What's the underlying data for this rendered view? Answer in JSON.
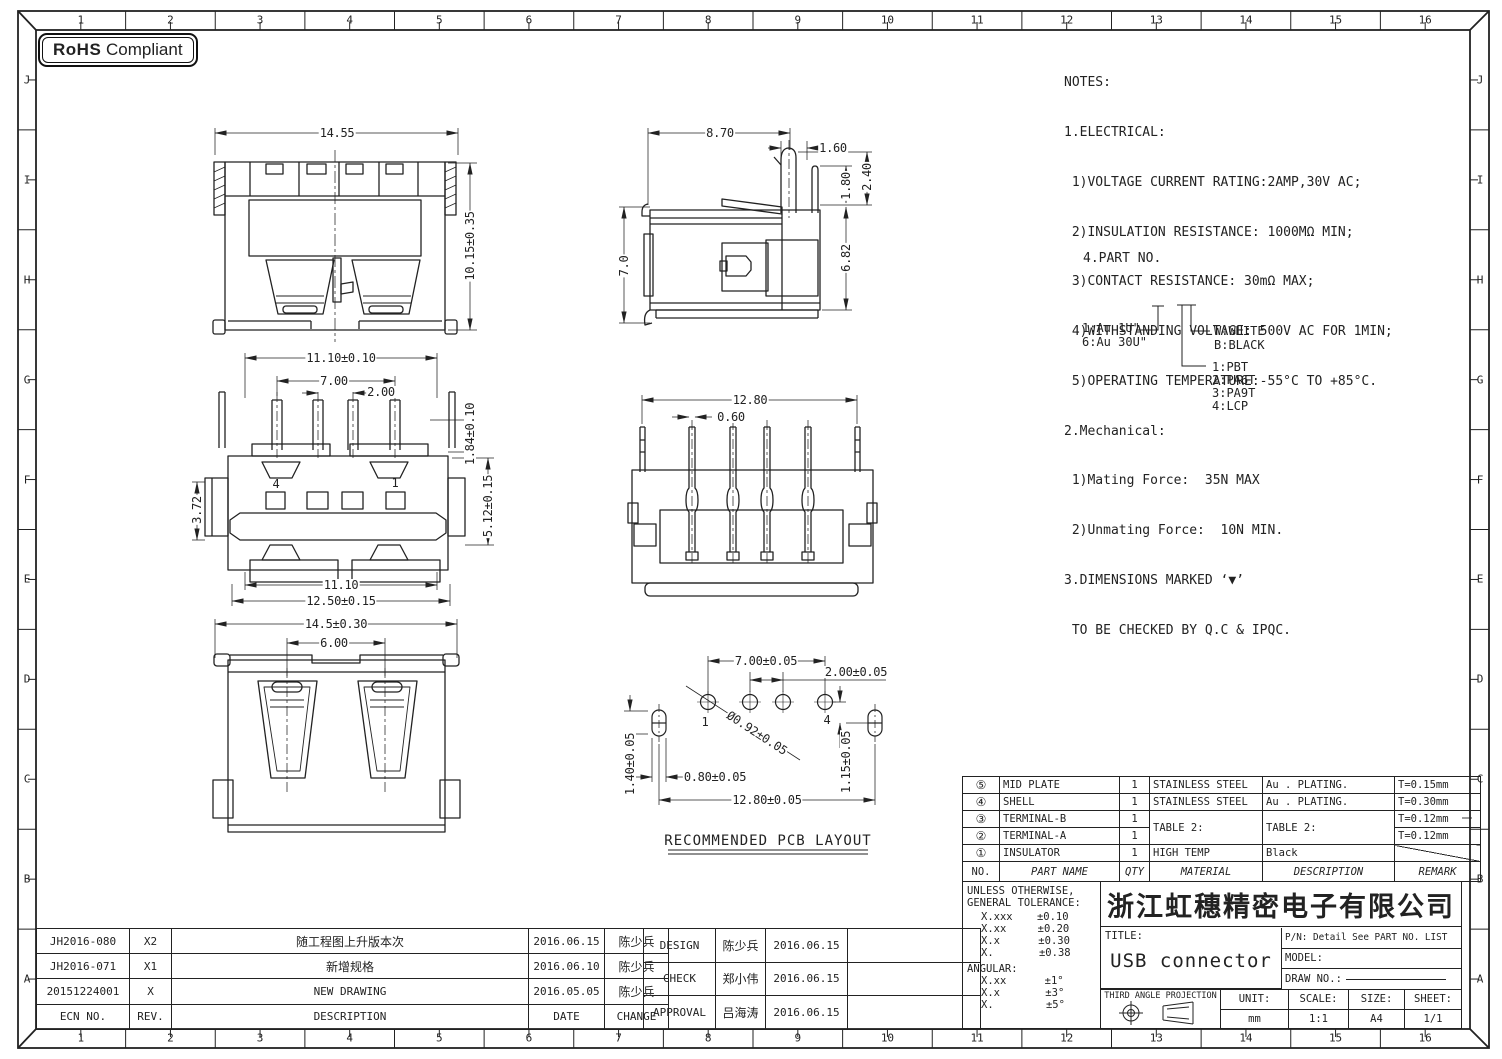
{
  "frame": {
    "numbers": [
      "1",
      "2",
      "3",
      "4",
      "5",
      "6",
      "7",
      "8",
      "9",
      "10",
      "11",
      "12",
      "13",
      "14",
      "15",
      "16"
    ],
    "letters": [
      "J",
      "I",
      "H",
      "G",
      "F",
      "E",
      "D",
      "C",
      "B",
      "A"
    ]
  },
  "rohs": {
    "strong": "RoHS",
    "text": "Compliant"
  },
  "notes": {
    "lines": [
      "NOTES:",
      "1.ELECTRICAL:",
      " 1)VOLTAGE CURRENT RATING:2AMP,30V AC;",
      " 2)INSULATION RESISTANCE: 1000MΩ MIN;",
      " 3)CONTACT RESISTANCE: 30mΩ MAX;",
      " 4)WITHSTANDING VOLTAGE: 500V AC FOR 1MIN;",
      " 5)OPERATING TEMPERATURE:-55°C TO +85°C.",
      "2.Mechanical:",
      " 1)Mating Force:  35N MAX",
      " 2)Unmating Force:  10N MIN.",
      "3.DIMENSIONS MARKED ‘▼’",
      " TO BE CHECKED BY Q.C & IPQC."
    ],
    "part_no_label": "4.PART NO."
  },
  "tree": {
    "plate1": "1:Au 1U\"",
    "plate2": "6:Au 30U\"",
    "c1": "W:WHITE",
    "c2": "B:BLACK",
    "m1": "1:PBT",
    "m2": "2:PA6T",
    "m3": "3:PA9T",
    "m4": "4:LCP"
  },
  "dims": {
    "v1_w": "14.55",
    "v1_h": "10.15±0.35",
    "v2_w": "8.70",
    "v2_a": "1.60",
    "v2_b": "1.80",
    "v2_c": "2.40",
    "v2_h": "7.0",
    "v2_d": "6.82",
    "v3_top": "11.10±0.10",
    "v3_a": "7.00",
    "v3_b": "2.00",
    "v3_c": "1.84±0.10",
    "v3_d": "3.72",
    "v3_e": "5.12±0.15",
    "v3_p4": "4",
    "v3_p1": "1",
    "v3_f": "11.10",
    "v3_g": "12.50±0.15",
    "v4_w": "12.80",
    "v4_a": "0.60",
    "v5_w": "14.5±0.30",
    "v5_a": "6.00",
    "p_a": "7.00±0.05",
    "p_b": "2.00±0.05",
    "p_1": "1",
    "p_4": "4",
    "p_dia": "Ø0.92±0.05",
    "p_c": "1.40±0.05",
    "p_d": "0.80±0.05",
    "p_e": "1.15±0.05",
    "p_f": "12.80±0.05"
  },
  "pcb_caption": "RECOMMENDED PCB LAYOUT",
  "bom": {
    "headers": [
      "NO.",
      "PART NAME",
      "QTY",
      "MATERIAL",
      "DESCRIPTION",
      "REMARK"
    ],
    "rows": [
      [
        "⑤",
        "MID PLATE",
        "1",
        "STAINLESS STEEL",
        "Au . PLATING.",
        "T=0.15mm"
      ],
      [
        "④",
        "SHELL",
        "1",
        "STAINLESS STEEL",
        "Au . PLATING.",
        "T=0.30mm"
      ],
      [
        "③",
        "TERMINAL-B",
        "1",
        "TABLE 2:",
        "TABLE 2:",
        "T=0.12mm"
      ],
      [
        "②",
        "TERMINAL-A",
        "1",
        "",
        "",
        "T=0.12mm"
      ],
      [
        "①",
        "INSULATOR",
        "1",
        "HIGH TEMP",
        "Black",
        ""
      ]
    ]
  },
  "tolerance": {
    "t1": "UNLESS OTHERWISE,",
    "t2": "GENERAL TOLERANCE:",
    "rows": [
      [
        "X.xxx",
        "±0.10"
      ],
      [
        "X.xx",
        "±0.20"
      ],
      [
        "X.x",
        "±0.30"
      ],
      [
        "X.",
        "±0.38"
      ]
    ],
    "angular": "ANGULAR:",
    "arows": [
      [
        "X.xx",
        "±1°"
      ],
      [
        "X.x",
        "±3°"
      ],
      [
        "X.",
        "±5°"
      ]
    ]
  },
  "title_block": {
    "company": "浙江虹穗精密电子有限公司",
    "title_label": "TITLE:",
    "title": "USB connector",
    "pn": "P/N: Detail See PART NO. LIST",
    "model": "MODEL:",
    "draw_no": "DRAW NO.:",
    "projection": "THIRD ANGLE PROJECTION",
    "unit_label": "UNIT:",
    "unit": "mm",
    "scale_label": "SCALE:",
    "scale": "1:1",
    "size_label": "SIZE:",
    "size": "A4",
    "sheet_label": "SHEET:",
    "sheet": "1/1"
  },
  "revisions": {
    "headers": [
      "ECN NO.",
      "REV.",
      "DESCRIPTION",
      "DATE",
      "CHANGE"
    ],
    "rows": [
      [
        "JH2016-080",
        "X2",
        "随工程图上升版本次",
        "2016.06.15",
        "陈少兵"
      ],
      [
        "JH2016-071",
        "X1",
        "新增规格",
        "2016.06.10",
        "陈少兵"
      ],
      [
        "20151224001",
        "X",
        "NEW DRAWING",
        "2016.05.05",
        "陈少兵"
      ]
    ]
  },
  "approvals": {
    "rows": [
      [
        "DESIGN",
        "陈少兵",
        "2016.06.15"
      ],
      [
        "CHECK",
        "郑小伟",
        "2016.06.15"
      ],
      [
        "APPROVAL",
        "吕海涛",
        "2016.06.15"
      ]
    ]
  }
}
